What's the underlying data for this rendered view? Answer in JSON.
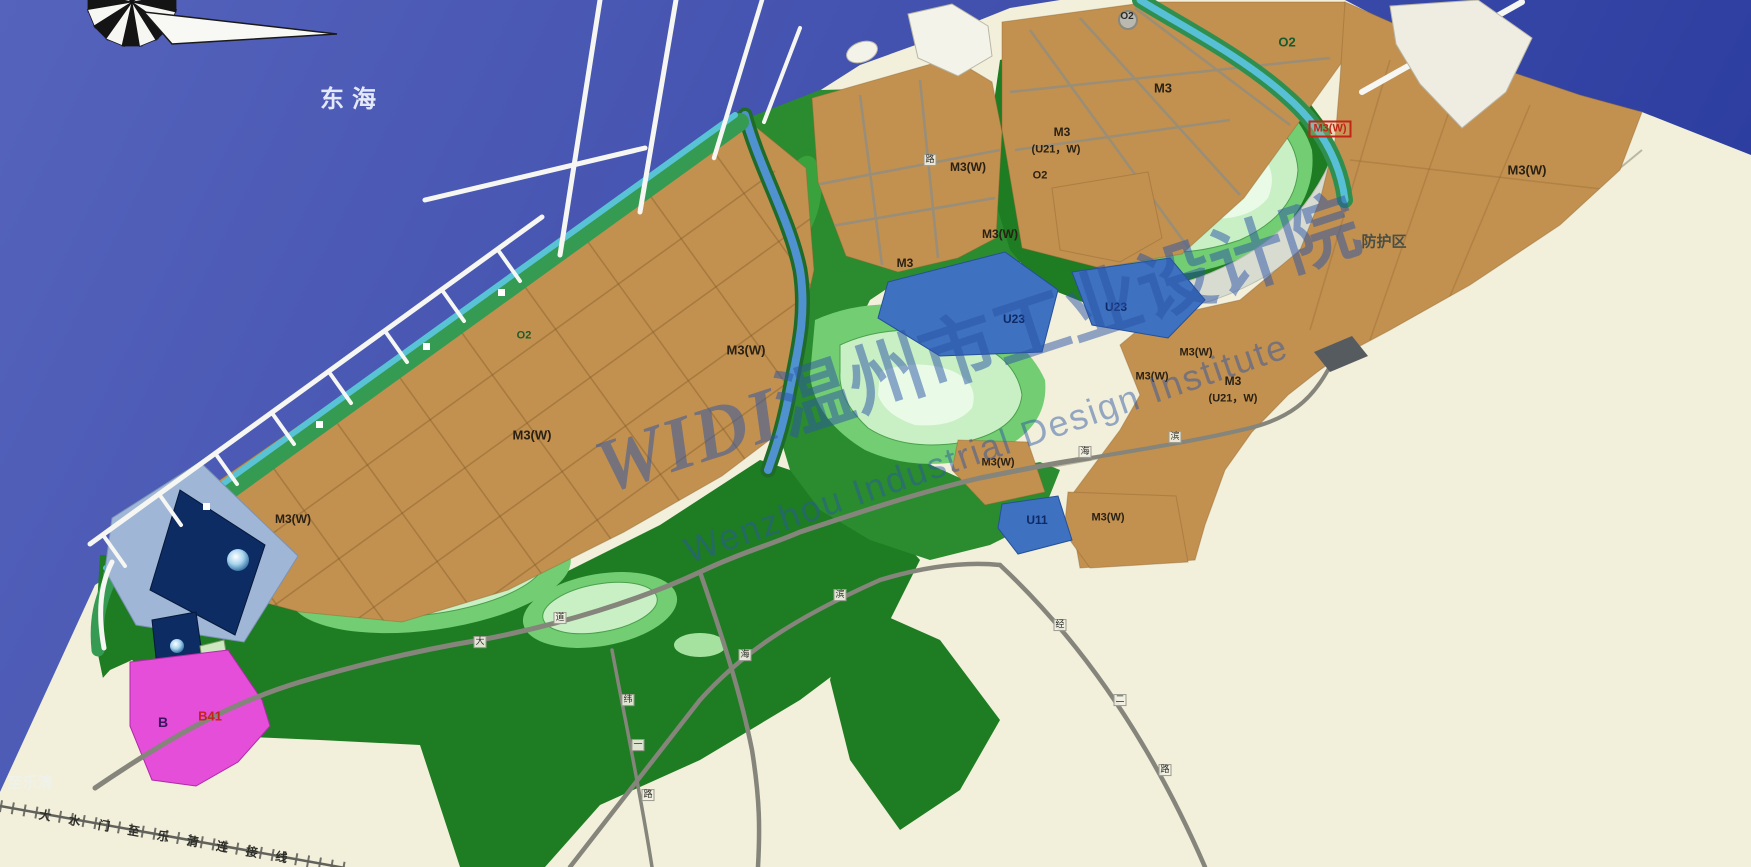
{
  "map": {
    "palette": {
      "sea_light": "#5563bc",
      "sea_dark": "#2c3da0",
      "land_cream": "#f2efda",
      "industrial_tan": "#c2904f",
      "hill_dark_green": "#1e7c22",
      "hill_pale_green": "#b6eab0",
      "coast_strip_green": "#359b52",
      "coast_strip_cyan": "#59c3d6",
      "utility_blue": "#3e71c0",
      "deep_navy": "#0c2c63",
      "commercial_magenta": "#e44ed9",
      "protection_gray": "#d8dbd0",
      "watermark_blue": "#2c55a8",
      "label_red": "#c22418"
    },
    "watermark": {
      "logo": "WIDI",
      "cjk": "温州市工业设计院",
      "en": "Wenzhou Industrial Design Institute"
    },
    "labels": [
      {
        "id": "sea-name",
        "text": "东海",
        "x": 352,
        "y": 100,
        "size": 24,
        "color": "#e4e9f7",
        "bold": true,
        "ls": 8
      },
      {
        "id": "to-yueqing",
        "text": "至乐清",
        "x": 30,
        "y": 783,
        "size": 15,
        "color": "#f0f2ea",
        "bold": false
      },
      {
        "id": "railway-name",
        "text": "大水门至乐清连接线",
        "x": 172,
        "y": 838,
        "size": 12,
        "color": "#2e2e28",
        "ls": 18,
        "rotate": 10
      },
      {
        "id": "zone-o2-strip",
        "text": "O2",
        "x": 524,
        "y": 336,
        "size": 11,
        "color": "#1c5b2a"
      },
      {
        "id": "zone-m3w-left-a",
        "text": "M3(W)",
        "x": 532,
        "y": 435,
        "size": 13
      },
      {
        "id": "zone-m3w-left-b",
        "text": "M3(W)",
        "x": 746,
        "y": 350,
        "size": 13
      },
      {
        "id": "zone-m3w-left-c",
        "text": "M3(W)",
        "x": 293,
        "y": 519,
        "size": 12
      },
      {
        "id": "zone-m3-mid-a",
        "text": "M3",
        "x": 905,
        "y": 263,
        "size": 12
      },
      {
        "id": "zone-m3w-mid-a",
        "text": "M3(W)",
        "x": 1000,
        "y": 234,
        "size": 12
      },
      {
        "id": "zone-m3w-mid-b",
        "text": "M3(W)",
        "x": 968,
        "y": 167,
        "size": 12
      },
      {
        "id": "zone-m3-stack",
        "text": "M3",
        "x": 1062,
        "y": 132,
        "size": 12
      },
      {
        "id": "zone-u21w-stack",
        "text": "(U21，W)",
        "x": 1056,
        "y": 150,
        "size": 11
      },
      {
        "id": "zone-o2-stack",
        "text": "O2",
        "x": 1040,
        "y": 176,
        "size": 11
      },
      {
        "id": "zone-o2-roundabout",
        "text": "O2",
        "x": 1127,
        "y": 17,
        "size": 10,
        "color": "#2a2a2a"
      },
      {
        "id": "zone-m3-top",
        "text": "M3",
        "x": 1163,
        "y": 88,
        "size": 13
      },
      {
        "id": "zone-o2-canal",
        "text": "O2",
        "x": 1287,
        "y": 42,
        "size": 13,
        "color": "#145c2e",
        "bold": true
      },
      {
        "id": "zone-m3w-red-boxed",
        "text": "M3(W)",
        "x": 1330,
        "y": 129,
        "size": 11,
        "color": "#c22418",
        "boxed": true
      },
      {
        "id": "zone-m3w-east",
        "text": "M3(W)",
        "x": 1527,
        "y": 170,
        "size": 13
      },
      {
        "id": "protection-zone",
        "text": "防护区",
        "x": 1384,
        "y": 242,
        "size": 15,
        "color": "#4a4f46"
      },
      {
        "id": "zone-u23-a",
        "text": "U23",
        "x": 1014,
        "y": 319,
        "size": 12,
        "color": "#0e2a66",
        "bold": true
      },
      {
        "id": "zone-u23-b",
        "text": "U23",
        "x": 1116,
        "y": 307,
        "size": 12,
        "color": "#0e2a66",
        "bold": true
      },
      {
        "id": "zone-m3w-se-a",
        "text": "M3(W)",
        "x": 1196,
        "y": 353,
        "size": 11
      },
      {
        "id": "zone-m3w-se-b",
        "text": "M3(W)",
        "x": 1152,
        "y": 377,
        "size": 11
      },
      {
        "id": "zone-m3-u21-a",
        "text": "M3",
        "x": 1233,
        "y": 381,
        "size": 12
      },
      {
        "id": "zone-m3-u21-b",
        "text": "(U21，W)",
        "x": 1233,
        "y": 399,
        "size": 11
      },
      {
        "id": "zone-m3w-small-diamond",
        "text": "M3(W)",
        "x": 998,
        "y": 463,
        "size": 11
      },
      {
        "id": "zone-u11",
        "text": "U11",
        "x": 1037,
        "y": 520,
        "size": 12,
        "color": "#0e2a66",
        "bold": true
      },
      {
        "id": "zone-m3w-s",
        "text": "M3(W)",
        "x": 1108,
        "y": 518,
        "size": 11
      },
      {
        "id": "zone-b",
        "text": "B",
        "x": 163,
        "y": 722,
        "size": 14,
        "color": "#3a1560",
        "bold": true
      },
      {
        "id": "zone-b41",
        "text": "B41",
        "x": 210,
        "y": 716,
        "size": 13,
        "color": "#c22418",
        "bold": true
      }
    ],
    "road_markers": [
      {
        "ch": "大",
        "x": 480,
        "y": 642
      },
      {
        "ch": "道",
        "x": 560,
        "y": 618
      },
      {
        "ch": "纬",
        "x": 628,
        "y": 700
      },
      {
        "ch": "一",
        "x": 638,
        "y": 745
      },
      {
        "ch": "路",
        "x": 648,
        "y": 795
      },
      {
        "ch": "海",
        "x": 745,
        "y": 655
      },
      {
        "ch": "滨",
        "x": 840,
        "y": 595
      },
      {
        "ch": "经",
        "x": 1060,
        "y": 625
      },
      {
        "ch": "二",
        "x": 1120,
        "y": 700
      },
      {
        "ch": "路",
        "x": 1165,
        "y": 770
      },
      {
        "ch": "路",
        "x": 930,
        "y": 160
      },
      {
        "ch": "海",
        "x": 1085,
        "y": 452
      },
      {
        "ch": "滨",
        "x": 1175,
        "y": 437
      }
    ]
  }
}
